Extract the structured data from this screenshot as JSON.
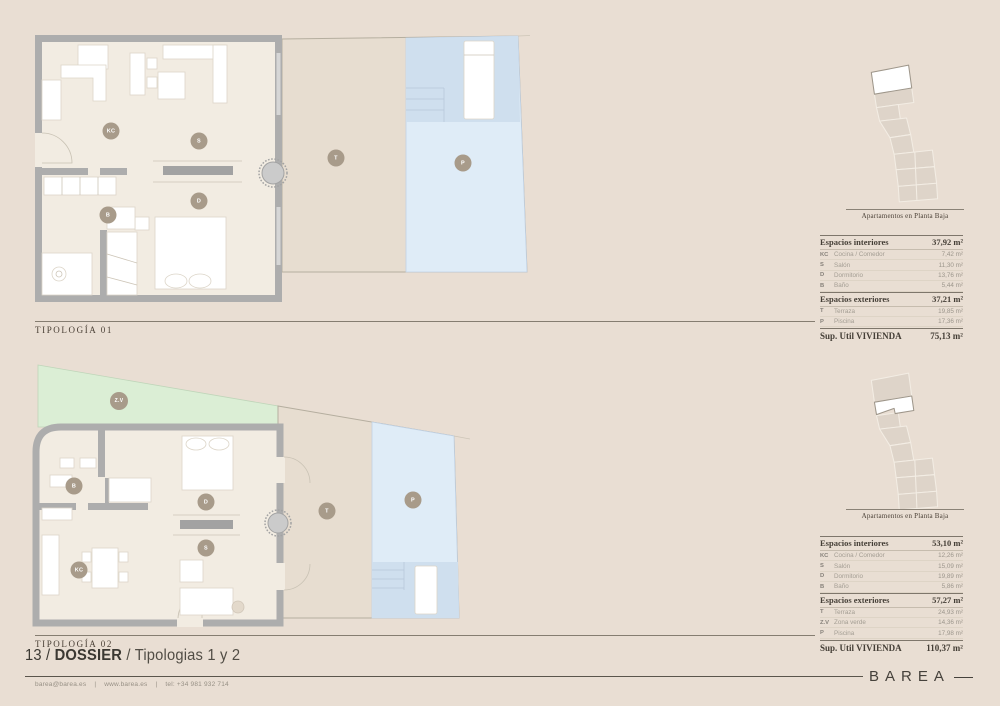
{
  "colors": {
    "page_bg": "#e9ded3",
    "floor": "#f2ece2",
    "wall": "#adadad",
    "terrace": "#e7ddd0",
    "pool": "#dfecf7",
    "pool_dark": "#cfdfee",
    "green": "#dbeed5",
    "label_bg": "#a89b8a",
    "ink": "#443e36",
    "muted": "#a39d93",
    "line_dark": "#7e766b",
    "brand_ink": "#45413b"
  },
  "plans": [
    {
      "title": "TIPOLOGÍA 01",
      "labels": {
        "kc": "KC",
        "s": "S",
        "b": "B",
        "d": "D",
        "t": "T",
        "p": "P"
      }
    },
    {
      "title": "TIPOLOGÍA 02",
      "labels": {
        "zv": "Z.V",
        "kc": "KC",
        "s": "S",
        "b": "B",
        "d": "D",
        "t": "T",
        "p": "P"
      }
    }
  ],
  "panels": [
    {
      "caption": "Apartamentos en Planta Baja",
      "interior_header": {
        "label": "Espacios interiores",
        "value": "37,92 m²"
      },
      "interior_rows": [
        {
          "code": "KC",
          "label": "Cocina / Comedor",
          "value": "7,42 m²"
        },
        {
          "code": "S",
          "label": "Salón",
          "value": "11,30 m²"
        },
        {
          "code": "D",
          "label": "Dormitorio",
          "value": "13,76 m²"
        },
        {
          "code": "B",
          "label": "Baño",
          "value": "5,44 m²"
        }
      ],
      "exterior_header": {
        "label": "Espacios exteriores",
        "value": "37,21 m²"
      },
      "exterior_rows": [
        {
          "code": "T",
          "label": "Terraza",
          "value": "19,85 m²"
        },
        {
          "code": "P",
          "label": "Piscina",
          "value": "17,36 m²"
        }
      ],
      "total": {
        "label": "Sup. Util VIVIENDA",
        "value": "75,13 m²"
      }
    },
    {
      "caption": "Apartamentos en Planta Baja",
      "interior_header": {
        "label": "Espacios interiores",
        "value": "53,10 m²"
      },
      "interior_rows": [
        {
          "code": "KC",
          "label": "Cocina / Comedor",
          "value": "12,26 m²"
        },
        {
          "code": "S",
          "label": "Salón",
          "value": "15,09 m²"
        },
        {
          "code": "D",
          "label": "Dormitorio",
          "value": "19,89 m²"
        },
        {
          "code": "B",
          "label": "Baño",
          "value": "5,86 m²"
        }
      ],
      "exterior_header": {
        "label": "Espacios exteriores",
        "value": "57,27 m²"
      },
      "exterior_rows": [
        {
          "code": "T",
          "label": "Terraza",
          "value": "24,93 m²"
        },
        {
          "code": "Z.V",
          "label": "Zona verde",
          "value": "14,36 m²"
        },
        {
          "code": "P",
          "label": "Piscina",
          "value": "17,98 m²"
        }
      ],
      "total": {
        "label": "Sup. Util VIVIENDA",
        "value": "110,37 m²"
      }
    }
  ],
  "footer": {
    "page_label": "13 /",
    "doc_title": "DOSSIER",
    "subtitle": "/ Tipologias 1 y 2",
    "contact": {
      "email": "barea@barea.es",
      "separator": "|",
      "web": "www.barea.es",
      "tel": "tel: +34 981 932 714"
    },
    "brand": "BAREA"
  }
}
